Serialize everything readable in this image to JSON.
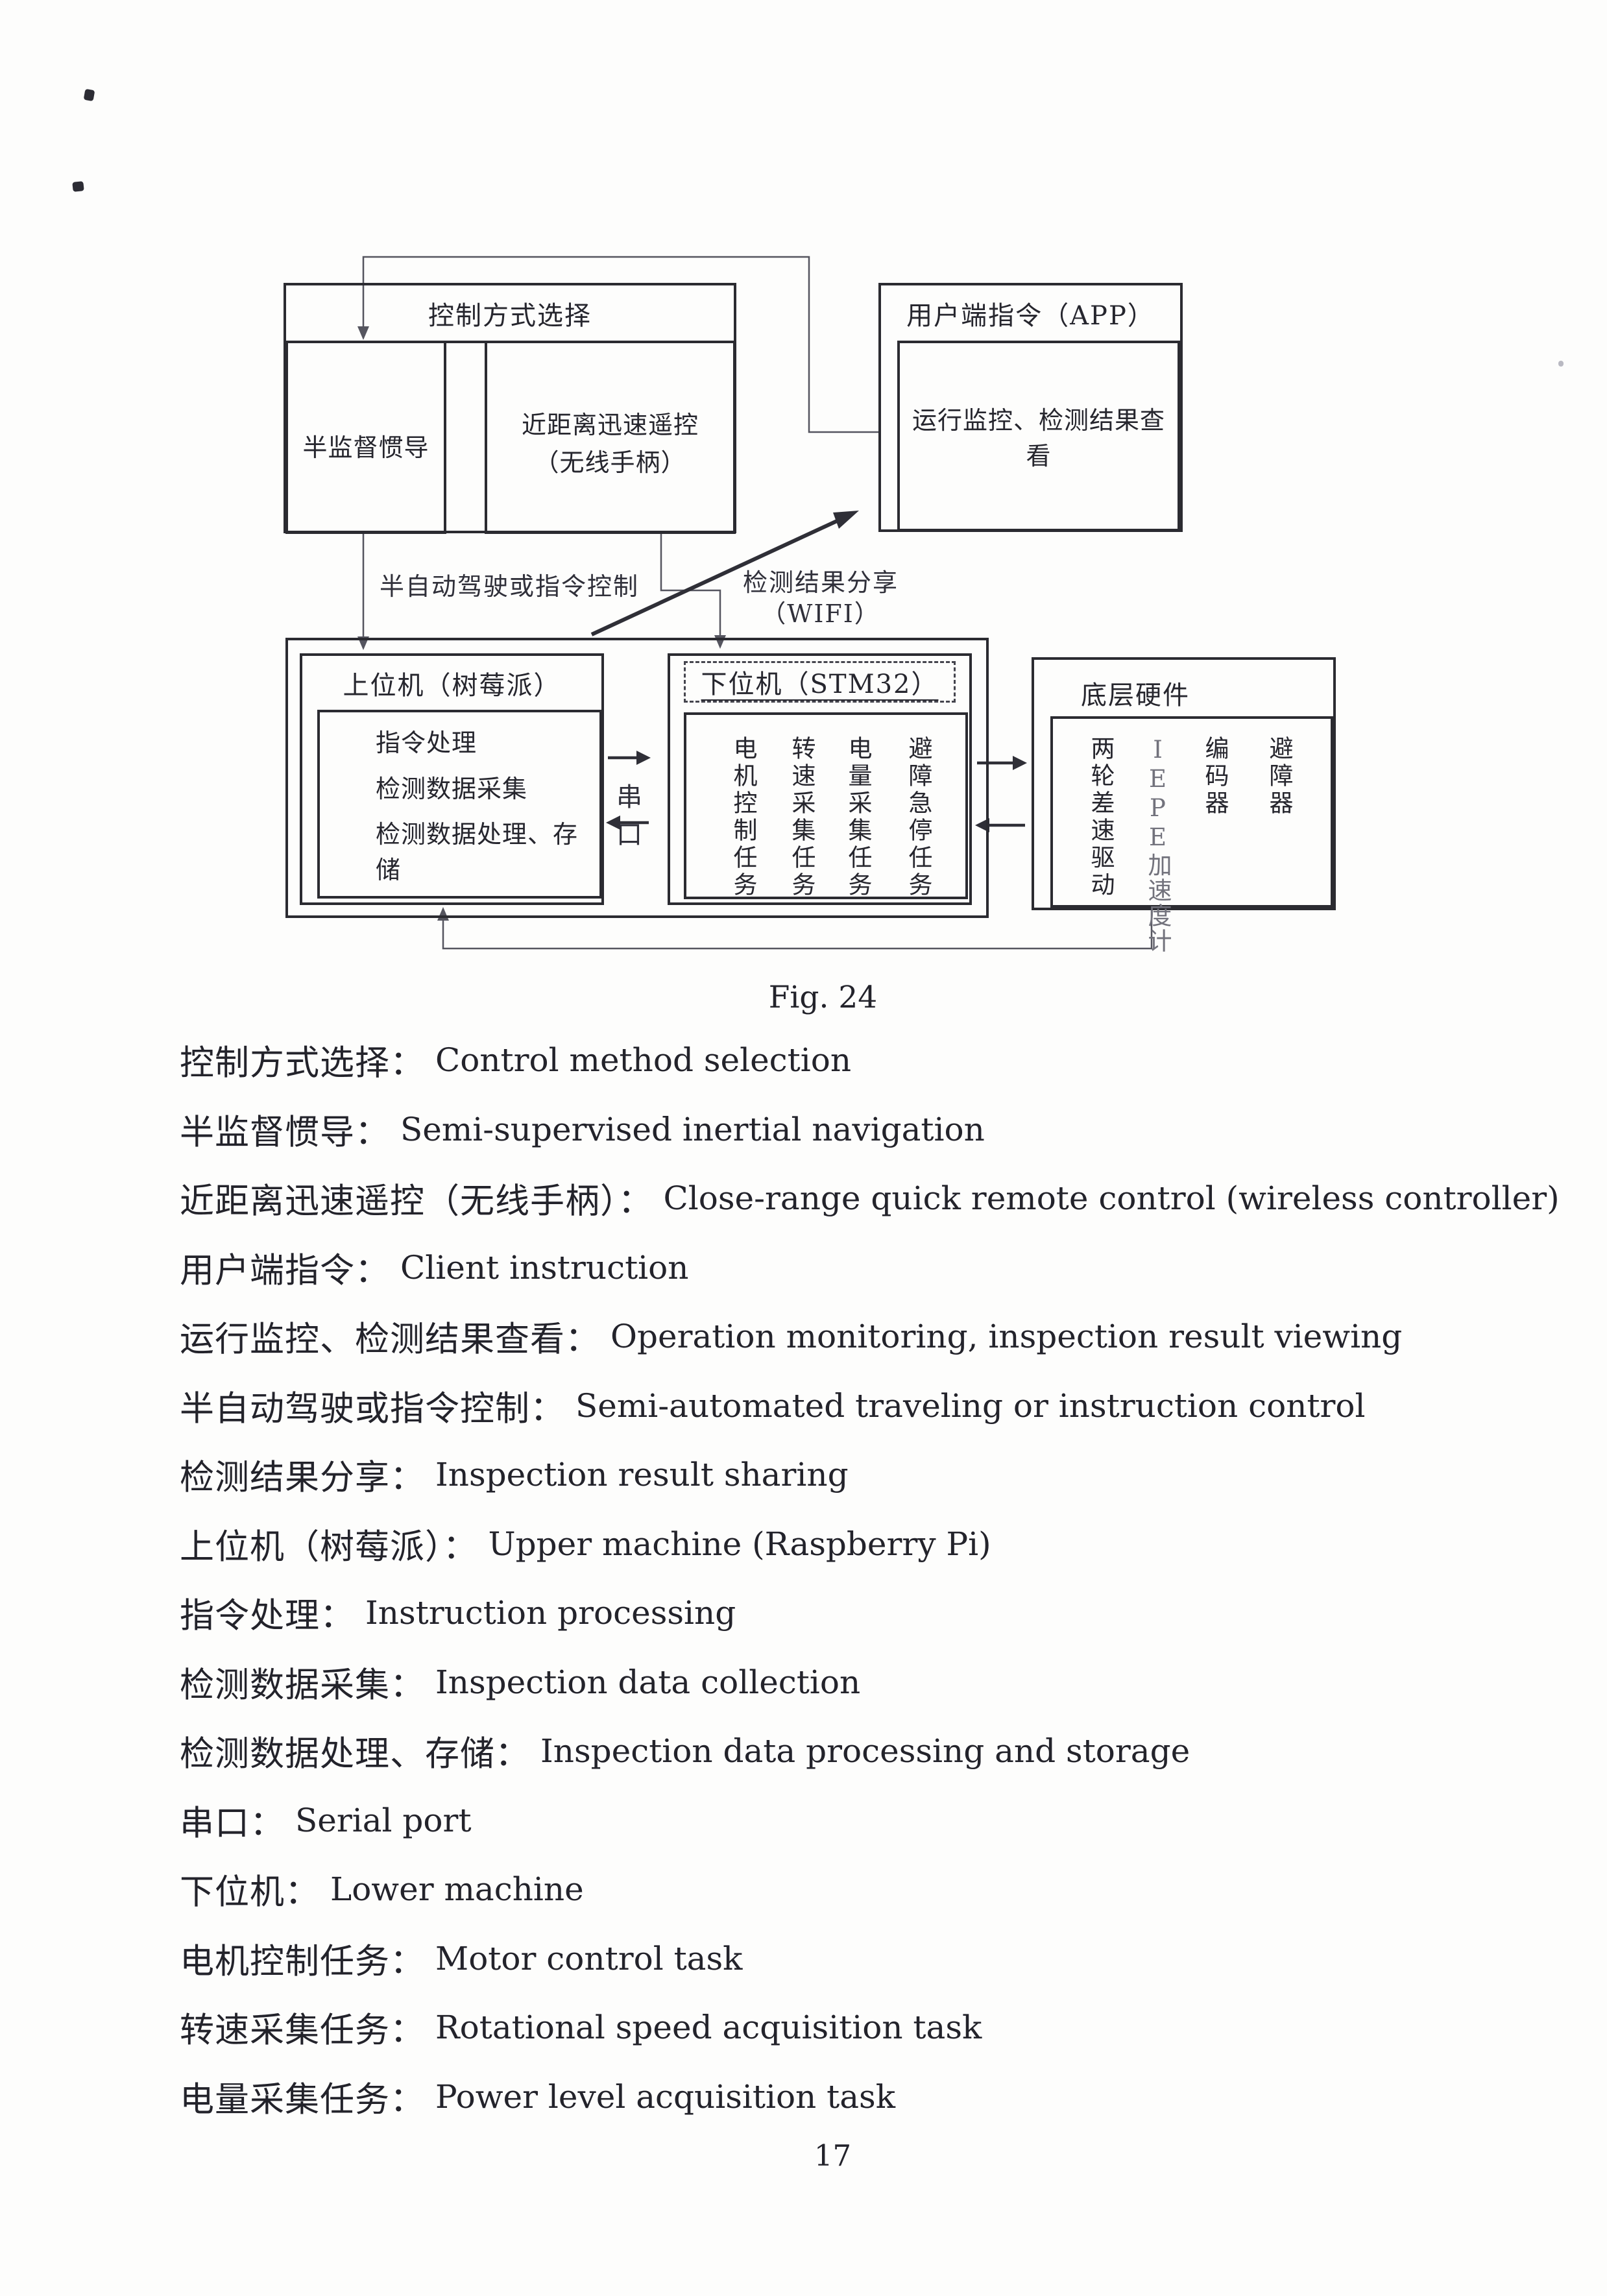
{
  "page": {
    "number": "17",
    "fig_caption": "Fig. 24"
  },
  "colors": {
    "ink": "#2b2b31",
    "connector": "#55555f",
    "arrow_dark": "#2f2f37",
    "paper": "#fdfdfc"
  },
  "diagram": {
    "control_box": {
      "title": "控制方式选择",
      "sub_left": "半监督惯导",
      "sub_right_line1": "近距离迅速遥控",
      "sub_right_line2": "（无线手柄）"
    },
    "app_box": {
      "title": "用户端指令（APP）",
      "inner": "运行监控、检测结果查看"
    },
    "labels": {
      "semi_auto": "半自动驾驶或指令控制",
      "share_line1": "检测结果分享",
      "share_line2": "（WIFI）",
      "serial": "串口"
    },
    "upper_box": {
      "title": "上位机（树莓派）",
      "items": [
        "指令处理",
        "检测数据采集",
        "检测数据处理、存储"
      ]
    },
    "lower_box": {
      "title": "下位机（STM32）",
      "tasks": [
        "电机控制任务",
        "转速采集任务",
        "电量采集任务",
        "避障急停任务"
      ]
    },
    "hardware_box": {
      "title": "底层硬件",
      "items": [
        "两轮差速驱动",
        "IEPE加速度计",
        "编码器",
        "避障器"
      ]
    }
  },
  "glossary": [
    {
      "zh": "控制方式选择：",
      "en": "Control method selection"
    },
    {
      "zh": "半监督惯导：",
      "en": "Semi-supervised inertial navigation"
    },
    {
      "zh": "近距离迅速遥控（无线手柄）：",
      "en": "Close-range quick remote control (wireless controller)"
    },
    {
      "zh": "用户端指令：",
      "en": "Client instruction"
    },
    {
      "zh": "运行监控、检测结果查看：",
      "en": "Operation monitoring, inspection result viewing"
    },
    {
      "zh": "半自动驾驶或指令控制：",
      "en": "Semi-automated traveling or instruction control"
    },
    {
      "zh": "检测结果分享：",
      "en": "Inspection result sharing"
    },
    {
      "zh": "上位机（树莓派）：",
      "en": "Upper machine (Raspberry Pi)"
    },
    {
      "zh": "指令处理：",
      "en": "Instruction processing"
    },
    {
      "zh": "检测数据采集：",
      "en": "Inspection data collection"
    },
    {
      "zh": "检测数据处理、存储：",
      "en": "Inspection data processing and storage"
    },
    {
      "zh": "串口：",
      "en": "Serial port"
    },
    {
      "zh": "下位机：",
      "en": "Lower machine"
    },
    {
      "zh": "电机控制任务：",
      "en": "Motor control task"
    },
    {
      "zh": "转速采集任务：",
      "en": "Rotational speed acquisition task"
    },
    {
      "zh": "电量采集任务：",
      "en": "Power level acquisition task"
    }
  ]
}
